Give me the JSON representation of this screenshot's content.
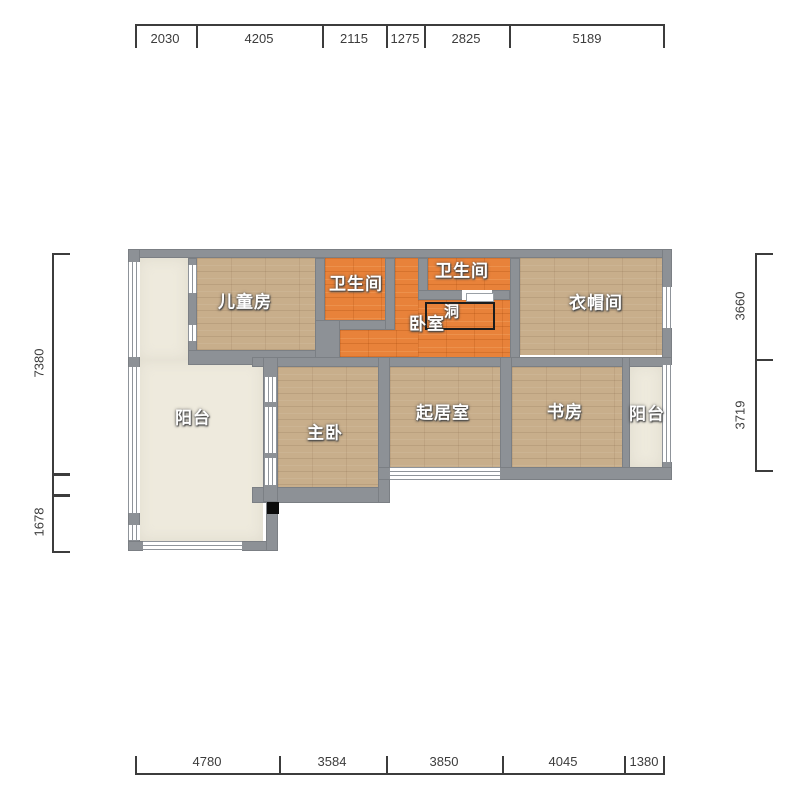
{
  "floor_plan": {
    "rooms": [
      {
        "id": "children-room",
        "label": "儿童房"
      },
      {
        "id": "bathroom-left",
        "label": "卫生间"
      },
      {
        "id": "bathroom-top",
        "label": "卫生间"
      },
      {
        "id": "bedroom",
        "label": "卧室"
      },
      {
        "id": "hole",
        "label": "洞"
      },
      {
        "id": "cloakroom",
        "label": "衣帽间"
      },
      {
        "id": "balcony-left",
        "label": "阳台"
      },
      {
        "id": "master-bedroom",
        "label": "主卧"
      },
      {
        "id": "living-room",
        "label": "起居室"
      },
      {
        "id": "study",
        "label": "书房"
      },
      {
        "id": "balcony-right",
        "label": "阳台"
      }
    ],
    "dim_top": [
      "2030",
      "4205",
      "2115",
      "1275",
      "2825",
      "5189"
    ],
    "dim_bottom": [
      "4780",
      "3584",
      "3850",
      "4045",
      "1380"
    ],
    "dim_left": [
      "7380",
      "1678"
    ],
    "dim_right": [
      "3660",
      "3719"
    ],
    "colors": {
      "wall": "#8d9196",
      "wood_floor": "#c8ae8b",
      "orange_floor": "#e8823a",
      "balcony_floor": "#eeeadd",
      "dim_text": "#3c3c3c",
      "hole_border": "#1c1c1c"
    }
  }
}
